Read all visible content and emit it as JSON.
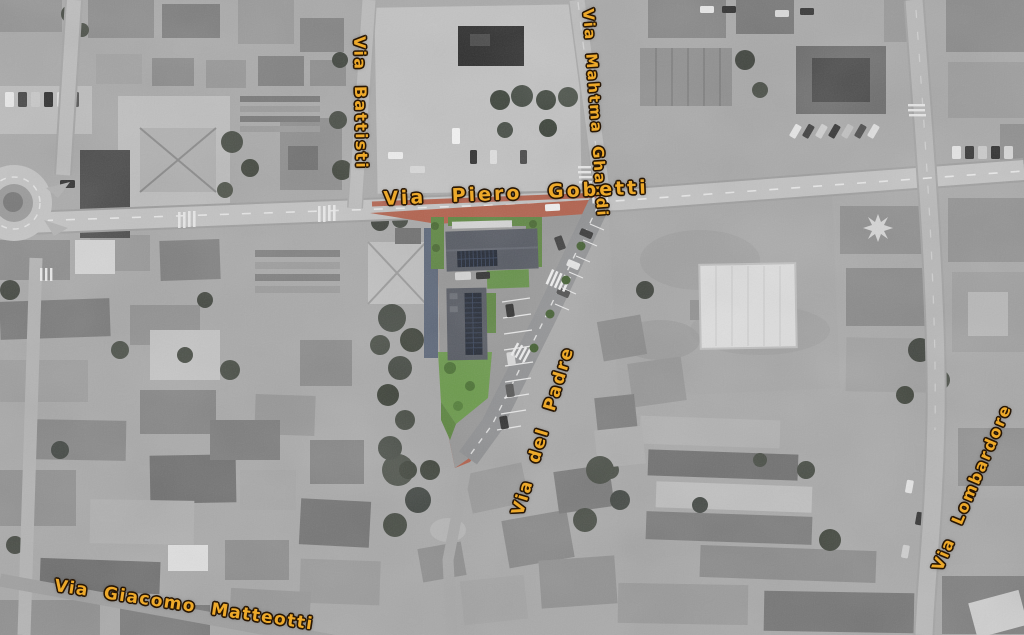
{
  "map": {
    "type": "aerial-photo-with-site-plan-overlay",
    "street_labels": [
      {
        "id": "via-battisti",
        "name": "Via Battisti"
      },
      {
        "id": "via-mahtma-ghandi",
        "name": "Via Mahtma Ghandi"
      },
      {
        "id": "via-piero-gobetti",
        "name": "Via Piero Gobetti"
      },
      {
        "id": "via-del-padre",
        "name": "Via del Padre"
      },
      {
        "id": "via-giacomo-matteotti",
        "name": "Via Giacomo Matteotti"
      },
      {
        "id": "via-lombardore",
        "name": "Via Lombardore"
      }
    ],
    "label_color": "#eda92a",
    "label_outline_color": "#271605",
    "overlay_colors": {
      "brick_paving": "#b2604b",
      "asphalt_road": "#8f9092",
      "new_building_roof": "#545861",
      "solar_panels": "#1f2531",
      "hedge_green": "#5d8640",
      "lawn_green": "#6b9a4b",
      "adjacent_roof_blue": "#5a6578"
    }
  }
}
